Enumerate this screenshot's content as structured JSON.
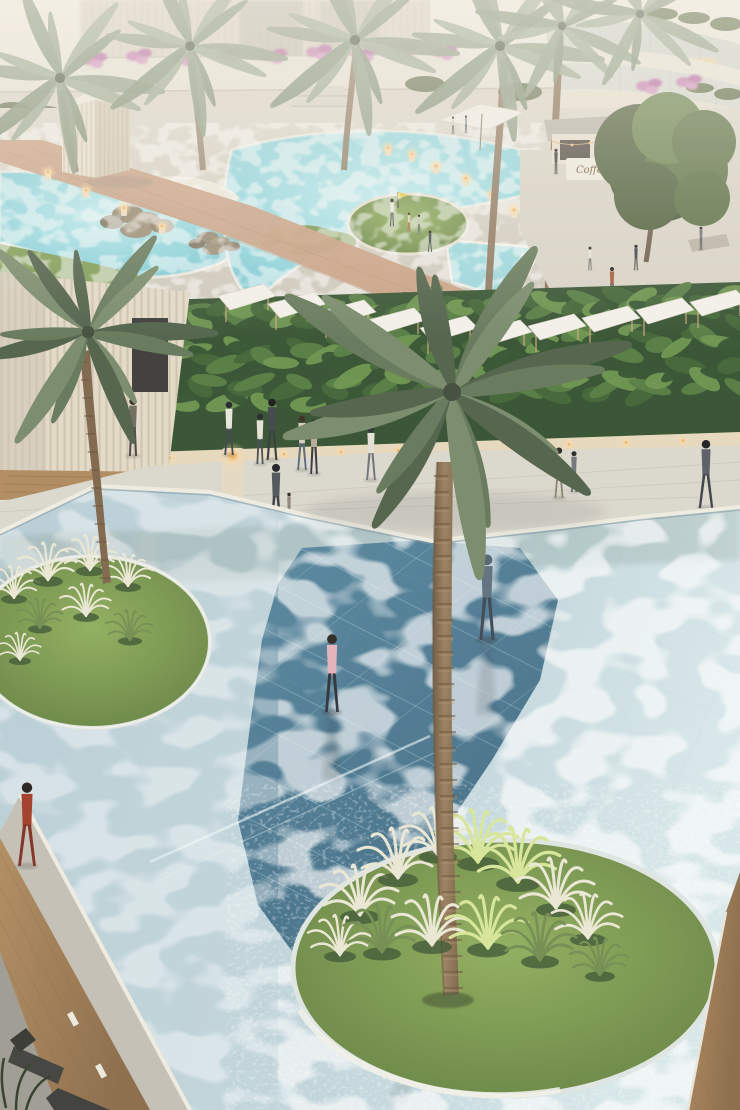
{
  "scene": {
    "type": "architectural-rendering",
    "description": "Aerial dusk view of a luxury resort: lagoon pools and cafe terrace above, tropical hedge with pergola shade sails mid-frame, and a vast shallow reflecting pool with circular grass islands and a central date palm below",
    "signage": {
      "cafe_sign": "Coffee"
    },
    "elements": [
      "residential building with curved balconies",
      "terraced flower walls",
      "lagoon pools with rocks",
      "mini-golf green",
      "outdoor cafe terrace",
      "coffee kiosk",
      "white patio umbrellas",
      "wicker lounge chairs",
      "slatted cream pavilion",
      "tropical hedge",
      "white pergola shade sails",
      "slatted facade with doorway",
      "candle bollards",
      "stone walkway",
      "shallow reflecting pool",
      "mosaic tile water inlay",
      "circular grass islands",
      "ornamental silver grasses",
      "date palm trees",
      "wood deck edges",
      "sun loungers"
    ],
    "people": [
      {
        "id": "backpack-man",
        "x": 133,
        "y": 396,
        "h": 60,
        "top": "#6e6a5e",
        "bottom": "#4a4742",
        "hair": "#2e2a24",
        "stride": 2,
        "layer": "layer-people-walkway",
        "desc": "man with backpack walking toward doorway"
      },
      {
        "id": "white-shirt-man",
        "x": 229,
        "y": 400,
        "h": 55,
        "top": "#e9e6dd",
        "bottom": "#3e434a",
        "hair": "#20232a",
        "stride": 3,
        "layer": "layer-people-walkway",
        "desc": "man in white shirt"
      },
      {
        "id": "suit-man",
        "x": 272,
        "y": 397,
        "h": 63,
        "top": "#3f444b",
        "bottom": "#33373d",
        "hair": "#16181b",
        "stride": 3,
        "layer": "layer-people-walkway",
        "desc": "man in dark suit"
      },
      {
        "id": "white-shirt-man-2",
        "x": 260,
        "y": 412,
        "h": 52,
        "top": "#e6e2d8",
        "bottom": "#474c54",
        "hair": "#23262a",
        "stride": 2,
        "layer": "layer-people-walkway",
        "desc": "second man in white shirt"
      },
      {
        "id": "walking-woman",
        "x": 302,
        "y": 414,
        "h": 56,
        "top": "#d9cfc2",
        "bottom": "#5a6878",
        "hair": "#3a2e24",
        "stride": 3,
        "layer": "layer-people-walkway",
        "desc": "woman in beige top and jeans"
      },
      {
        "id": "walking-woman-2",
        "x": 314,
        "y": 418,
        "h": 56,
        "top": "#b9aa9a",
        "bottom": "#32363c",
        "hair": "#1c1710",
        "stride": 2,
        "layer": "layer-people-walkway",
        "desc": "woman in taupe top"
      },
      {
        "id": "father-with-child",
        "x": 276,
        "y": 462,
        "h": 66,
        "top": "#4b535a",
        "bottom": "#343a40",
        "hair": "#1d2024",
        "stride": 3,
        "layer": "layer-people-walkway",
        "desc": "man carrying a child"
      },
      {
        "id": "toddler",
        "x": 289,
        "y": 492,
        "h": 28,
        "top": "#8c8578",
        "bottom": "#6b655c",
        "hair": "#2a241e",
        "stride": 2,
        "layer": "layer-people-walkway",
        "desc": "toddler beside him"
      },
      {
        "id": "palm-side-walker",
        "x": 371,
        "y": 424,
        "h": 56,
        "top": "#e4e0d6",
        "bottom": "#6b7078",
        "hair": "#2b2d31",
        "stride": 3,
        "layer": "layer-people-walkway",
        "desc": "walker near palm"
      },
      {
        "id": "khaki-man",
        "x": 559,
        "y": 446,
        "h": 52,
        "top": "#d9d3c5",
        "bottom": "#8c8170",
        "hair": "#2c2620",
        "stride": 3,
        "layer": "layer-people-walkway",
        "desc": "man in khaki"
      },
      {
        "id": "grey-walker",
        "x": 574,
        "y": 450,
        "h": 42,
        "top": "#70747a",
        "bottom": "#4a4e54",
        "hair": "#232528",
        "stride": 2,
        "layer": "layer-people-walkway",
        "desc": "man in grey"
      },
      {
        "id": "right-walker",
        "x": 706,
        "y": 438,
        "h": 70,
        "top": "#585c64",
        "bottom": "#3b3f46",
        "hair": "#1b1d21",
        "stride": 4,
        "layer": "layer-people-walkway",
        "desc": "tall walker far right"
      },
      {
        "id": "golf-flag-man",
        "x": 392,
        "y": 198,
        "h": 28,
        "top": "#eceadf",
        "bottom": "#3c4148",
        "hair": "#2a2622",
        "stride": 2,
        "layer": "layer-people-upper",
        "desc": "man holding golf flag"
      },
      {
        "id": "golf-kid",
        "x": 409,
        "y": 212,
        "h": 20,
        "top": "#d8d0c2",
        "bottom": "#b05038",
        "hair": "#2a241e",
        "stride": 2,
        "layer": "layer-people-upper",
        "desc": "child on green"
      },
      {
        "id": "golf-kid-2",
        "x": 419,
        "y": 214,
        "h": 20,
        "top": "#c8bfae",
        "bottom": "#4a4e54",
        "hair": "#201c18",
        "stride": 2,
        "layer": "layer-people-upper",
        "desc": "child on green"
      },
      {
        "id": "golf-kid-3",
        "x": 430,
        "y": 230,
        "h": 22,
        "top": "#3f444a",
        "bottom": "#2c3034",
        "hair": "#1b1815",
        "stride": 3,
        "layer": "layer-people-upper",
        "desc": "child running"
      },
      {
        "id": "barista",
        "x": 556,
        "y": 148,
        "h": 26,
        "top": "#2f3338",
        "bottom": "#222428",
        "hair": "#131517",
        "stride": 1,
        "layer": "layer-people-upper",
        "desc": "person at kiosk"
      },
      {
        "id": "cafe-walker",
        "x": 636,
        "y": 244,
        "h": 26,
        "top": "#3a3e44",
        "bottom": "#26282c",
        "hair": "#141618",
        "stride": 2,
        "layer": "layer-people-upper",
        "desc": "walker by cafe"
      },
      {
        "id": "cafe-walker-2",
        "x": 590,
        "y": 246,
        "h": 24,
        "top": "#e8e4da",
        "bottom": "#5a5e64",
        "hair": "#26221e",
        "stride": 2,
        "layer": "layer-people-upper",
        "desc": "walker by cafe"
      },
      {
        "id": "bench-sitter",
        "x": 701,
        "y": 226,
        "h": 24,
        "top": "#6b6f75",
        "bottom": "#44474c",
        "hair": "#1e2022",
        "stride": 1,
        "layer": "layer-people-upper",
        "desc": "person seated right"
      },
      {
        "id": "bridge-walker",
        "x": 612,
        "y": 266,
        "h": 34,
        "top": "#a65a3c",
        "bottom": "#3c3f45",
        "hair": "#221d18",
        "stride": 3,
        "layer": "layer-people-upper",
        "desc": "person crossing wood bridge"
      },
      {
        "id": "pool-edge-croucher",
        "x": 628,
        "y": 304,
        "h": 20,
        "top": "#4a4e54",
        "bottom": "#33363a",
        "hair": "#191b1d",
        "stride": 1,
        "layer": "layer-people-upper",
        "desc": "crouching person with dog"
      },
      {
        "id": "terrace-walker",
        "x": 453,
        "y": 116,
        "h": 18,
        "top": "#d8d2c6",
        "bottom": "#44484e",
        "hair": "#23201c",
        "stride": 2,
        "layer": "layer-people-upper",
        "desc": "walker on terrace"
      },
      {
        "id": "terrace-walker-2",
        "x": 466,
        "y": 115,
        "h": 18,
        "top": "#9aa0a6",
        "bottom": "#3a3e44",
        "hair": "#1c1916",
        "stride": 2,
        "layer": "layer-people-upper",
        "desc": "walker on terrace"
      },
      {
        "id": "pink-cardigan-wader",
        "x": 332,
        "y": 632,
        "h": 80,
        "top": "#e5b3bc",
        "bottom": "#2c3036",
        "hair": "#2a2622",
        "stride": 3,
        "reflect": true,
        "layer": "layer-people-water",
        "desc": "woman in pink cardigan wading"
      },
      {
        "id": "hoodie-wader",
        "x": 487,
        "y": 552,
        "h": 88,
        "top": "#5d6e7c",
        "bottom": "#3b4552",
        "hair": "#54636f",
        "stride": 3,
        "reflect": true,
        "layer": "layer-people-water",
        "desc": "man in grey hoodie wading"
      },
      {
        "id": "red-dress-walker",
        "x": 27,
        "y": 780,
        "h": 86,
        "top": "#a23a28",
        "bottom": "#7e2d20",
        "hair": "#241f1c",
        "stride": 4,
        "layer": "layer-front",
        "desc": "woman in red dress on deck edge"
      }
    ],
    "palms": [
      {
        "x": 452,
        "y": 392,
        "s": 1.5,
        "n": 16,
        "tint": "main",
        "layer": "layer-mainpalm-crown",
        "desc": "central date palm crown"
      },
      {
        "x": 88,
        "y": 332,
        "s": 1.05,
        "n": 13,
        "tint": "main",
        "layer": "layer-leftpalm",
        "desc": "left date palm crown"
      },
      {
        "x": 60,
        "y": 78,
        "s": 0.85,
        "n": 12,
        "tint": "haze",
        "layer": "layer-toppalms"
      },
      {
        "x": 190,
        "y": 46,
        "s": 0.8,
        "n": 12,
        "tint": "haze",
        "layer": "layer-toppalms"
      },
      {
        "x": 355,
        "y": 40,
        "s": 0.85,
        "n": 12,
        "tint": "haze",
        "layer": "layer-toppalms"
      },
      {
        "x": 500,
        "y": 46,
        "s": 0.85,
        "n": 12,
        "tint": "haze",
        "layer": "layer-toppalms"
      },
      {
        "x": 562,
        "y": 26,
        "s": 0.7,
        "n": 10,
        "tint": "haze",
        "layer": "layer-toppalms"
      },
      {
        "x": 640,
        "y": 14,
        "s": 0.7,
        "n": 10,
        "tint": "haze",
        "layer": "layer-toppalms"
      }
    ],
    "grass_tufts": [
      [
        14,
        598,
        1.3,
        "silver",
        "layer-tufts-small"
      ],
      [
        48,
        580,
        1.5,
        "silver",
        "layer-tufts-small"
      ],
      [
        90,
        570,
        1.4,
        "silver",
        "layer-tufts-small"
      ],
      [
        128,
        586,
        1.3,
        "silver",
        "layer-tufts-small"
      ],
      [
        40,
        628,
        1.2,
        "green",
        "layer-tufts-small"
      ],
      [
        86,
        616,
        1.3,
        "silver",
        "layer-tufts-small"
      ],
      [
        130,
        640,
        1.2,
        "green",
        "layer-tufts-small"
      ],
      [
        20,
        660,
        1.1,
        "silver",
        "layer-tufts-small"
      ],
      [
        360,
        915,
        2.0,
        "silver",
        "layer-tufts-big"
      ],
      [
        398,
        878,
        2.0,
        "silver",
        "layer-tufts-big"
      ],
      [
        438,
        855,
        1.9,
        "silver",
        "layer-tufts-big"
      ],
      [
        478,
        862,
        2.1,
        "lime",
        "layer-tufts-big"
      ],
      [
        518,
        882,
        2.2,
        "lime",
        "layer-tufts-big"
      ],
      [
        556,
        908,
        2.0,
        "silver",
        "layer-tufts-big"
      ],
      [
        588,
        938,
        1.8,
        "silver",
        "layer-tufts-big"
      ],
      [
        340,
        955,
        1.6,
        "silver",
        "layer-tufts-big"
      ],
      [
        600,
        975,
        1.5,
        "green",
        "layer-tufts-big"
      ],
      [
        382,
        952,
        1.9,
        "green",
        "layer-tufts-front"
      ],
      [
        432,
        945,
        2.0,
        "silver",
        "layer-tufts-front"
      ],
      [
        488,
        948,
        2.1,
        "lime",
        "layer-tufts-front"
      ],
      [
        540,
        960,
        1.9,
        "green",
        "layer-tufts-front"
      ]
    ],
    "flower_clusters": [
      [
        95,
        60
      ],
      [
        140,
        56
      ],
      [
        185,
        58
      ],
      [
        230,
        54
      ],
      [
        275,
        56
      ],
      [
        320,
        52
      ],
      [
        365,
        54
      ],
      [
        405,
        50
      ],
      [
        445,
        52
      ],
      [
        650,
        86
      ],
      [
        690,
        82
      ],
      [
        720,
        150
      ],
      [
        726,
        176
      ],
      [
        714,
        200
      ],
      [
        660,
        120
      ]
    ],
    "rock_clusters": [
      [
        128,
        214,
        1.0
      ],
      [
        208,
        238,
        0.7
      ],
      [
        408,
        312,
        0.9
      ]
    ],
    "pergola_sails": [
      [
        218,
        286
      ],
      [
        268,
        294
      ],
      [
        318,
        302
      ],
      [
        368,
        310
      ],
      [
        420,
        318
      ],
      [
        474,
        322
      ],
      [
        528,
        316
      ],
      [
        582,
        308
      ],
      [
        636,
        300
      ],
      [
        690,
        292
      ]
    ],
    "bollards": [
      [
        388,
        146
      ],
      [
        412,
        152
      ],
      [
        436,
        164
      ],
      [
        466,
        176
      ],
      [
        492,
        192
      ],
      [
        514,
        208
      ],
      [
        536,
        222
      ],
      [
        48,
        170
      ],
      [
        86,
        188
      ],
      [
        124,
        206
      ],
      [
        162,
        224
      ]
    ]
  },
  "palette": {
    "sky_haze": "#efe9e0",
    "facade_cream": "#e3dac8",
    "pavilion_cream": "#e8e0cf",
    "deck_paver": "#d7d1c5",
    "walkway_paver": "#dbd7ce",
    "terracotta": "#c89e82",
    "cafe_floor": "#d9d3c7",
    "pool_turquoise": "#7ecbd6",
    "pool_pale": "#b7cdd6",
    "pool_mosaic": "#4e7e97",
    "grass_green": "#7c9a52",
    "hedge_dark": "#33502f",
    "wood_deck": "#a9805a",
    "deck_stone": "#c3bfb5",
    "deck_dark": "#9d9a92",
    "coping_white": "#efebe1",
    "lantern_glow": "#f4b868",
    "flower_pink": "#c77fb2",
    "sign_text": "#6b5338"
  }
}
